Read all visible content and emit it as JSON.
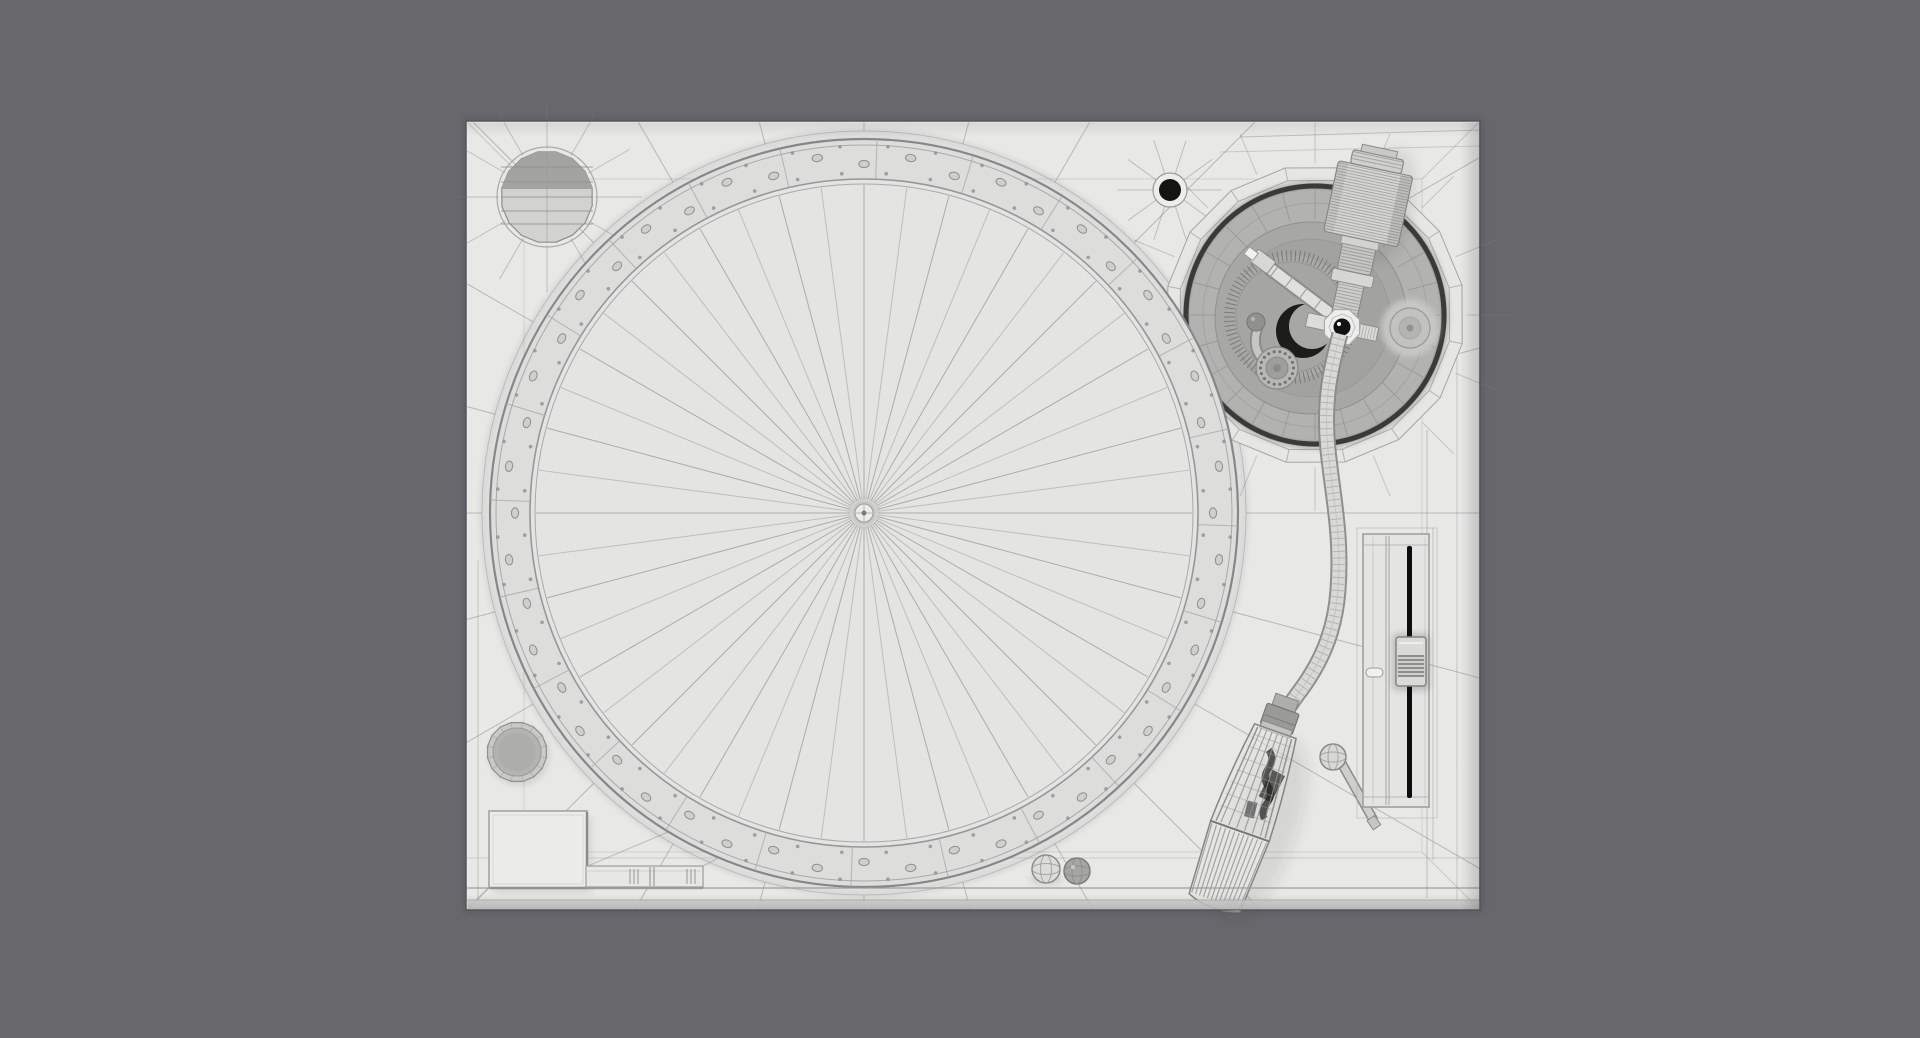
{
  "scene": {
    "description": "Monochrome clay-wireframe 3D render of a DJ turntable seen from directly above, centered on a dark gray backdrop",
    "style": "wireframe-clay-render",
    "view": "top-down"
  },
  "palette": {
    "background": "#67676c",
    "plinth": "#e8e8e7",
    "plinth_edge": "#54545a",
    "mesh_line": "#7d7d7c",
    "platter_face": "#e4e4e3",
    "strobe_band": "#dddddc",
    "band_dot_fill": "#cfcfce",
    "band_dot_edge": "#8f8f8e",
    "line_soft": "#a9a9a8",
    "line_mid": "#8e8e8d",
    "well_rim": "#e6e6e5",
    "well_gap_dark": "#2b2b2a",
    "well_floor": "#b2b2b1",
    "well_plate": "#a7a7a6",
    "metal_light": "#d7d7d6",
    "metal_mid": "#c2c2c1",
    "black_part": "#141413",
    "slot_black": "#0e0e0e",
    "white_part": "#f1f1f0"
  },
  "geometry": {
    "plinth": {
      "x": 466,
      "y": 121,
      "width": 1014,
      "height": 789
    },
    "platter": {
      "cx": 864,
      "cy": 513,
      "outer_radius": 374,
      "inner_radius": 334,
      "spoke_count": 48,
      "segment_count": 24,
      "strobe_dot_count": 48
    },
    "adapter_well": {
      "cx": 547,
      "cy": 197,
      "radius": 46
    },
    "plinth_hole": {
      "cx": 1170,
      "cy": 190,
      "radius": 11
    },
    "tonearm_well": {
      "cx": 1315,
      "cy": 315,
      "rim_radius": 150,
      "floor_radius": 125,
      "gear_teeth": 88
    },
    "counterweight": {
      "pivot_x": 1342,
      "pivot_y": 327,
      "tilt_deg": 12
    },
    "headshell": {
      "x": 1280,
      "y": 718,
      "tilt_deg": 19.5
    },
    "pitch_fader": {
      "x": 1363,
      "y": 534,
      "width": 66,
      "height": 273,
      "knob_x": 1396,
      "knob_y": 637,
      "knob_w": 30,
      "knob_h": 49
    },
    "power_knob": {
      "cx": 517,
      "cy": 752,
      "radius": 30
    },
    "start_stop_button": {
      "x": 489,
      "y": 811,
      "width": 98,
      "height": 77
    },
    "speed_buttons": {
      "x": 586,
      "y": 866,
      "width": 117,
      "height": 21
    },
    "stylus_lamp_balls": [
      {
        "cx": 1046,
        "cy": 869,
        "r": 14
      },
      {
        "cx": 1077,
        "cy": 871,
        "r": 13
      }
    ],
    "finger_lift": {
      "cx": 1333,
      "cy": 757,
      "r": 13
    }
  }
}
